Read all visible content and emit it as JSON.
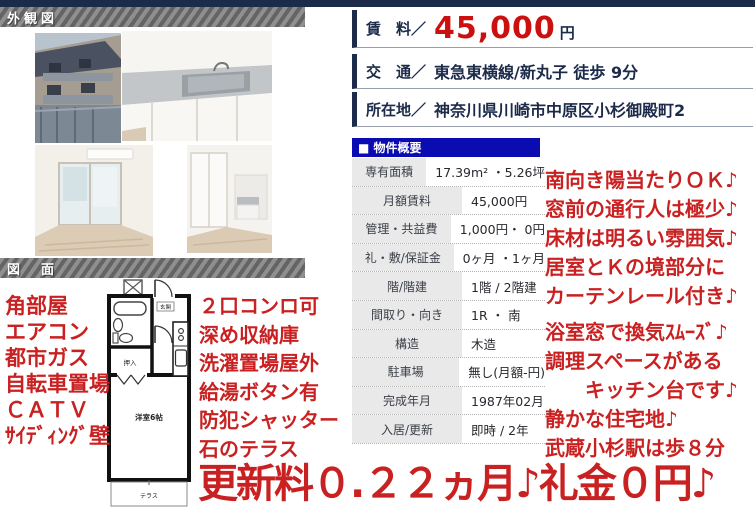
{
  "sections": {
    "exterior_bar": "外観図",
    "plan_bar": "図　面"
  },
  "listing": {
    "rent_label": "賃　料／",
    "rent_value": "45,000",
    "rent_unit": "円",
    "access_label": "交　通／",
    "access_value": "東急東横線/新丸子 徒歩 9分",
    "address_label": "所在地／",
    "address_value": "神奈川県川崎市中原区小杉御殿町2"
  },
  "overview": {
    "title": "■ 物件概要",
    "rows": [
      {
        "label": "専有面積",
        "value": "17.39m² ・5.26坪"
      },
      {
        "label": "月額賃料",
        "value": "45,000円"
      },
      {
        "label": "管理・共益費",
        "value": "1,000円・ 0円"
      },
      {
        "label": "礼・敷/保証金",
        "value": "0ヶ月 ・1ヶ月"
      },
      {
        "label": "階/階建",
        "value": "1階 / 2階建"
      },
      {
        "label": "間取り・向き",
        "value": "1R ・ 南"
      },
      {
        "label": "構造",
        "value": "木造"
      },
      {
        "label": "駐車場",
        "value": "無し(月額-円)"
      },
      {
        "label": "完成年月",
        "value": "1987年02月"
      },
      {
        "label": "入居/更新",
        "value": "即時 / 2年"
      }
    ]
  },
  "floorplan": {
    "genkan": "玄関",
    "oshiire": "押入",
    "room": "洋室6帖",
    "terrace": "テラス"
  },
  "annotations": {
    "left": [
      "角部屋",
      "エアコン",
      "都市ガス",
      "自転車置場",
      "ＣＡＴＶ",
      "ｻｲﾃﾞｨﾝｸﾞ壁"
    ],
    "middle": [
      "２口コンロ可",
      "深め収納庫",
      "洗濯置場屋外",
      "給湯ボタン有",
      "防犯シャッター",
      "石のテラス"
    ],
    "right": [
      "南向き陽当たりＯＫ♪",
      "窓前の通行人は極少♪",
      "床材は明るい雰囲気♪",
      "居室とＫの境部分に",
      "カーテンレール付き♪",
      "浴室窓で換気ｽﾑｰｽﾞ♪",
      "調理スペースがある",
      "キッチン台です♪",
      "静かな住宅地♪",
      "武蔵小杉駅は歩８分"
    ],
    "banner": "更新料０.２２ヵ月♪礼金０円♪"
  },
  "colors": {
    "navy": "#1c2b4a",
    "header_blue": "#0b0bb2",
    "annotation_red": "#c92121",
    "rent_red": "#cc0f0f"
  }
}
